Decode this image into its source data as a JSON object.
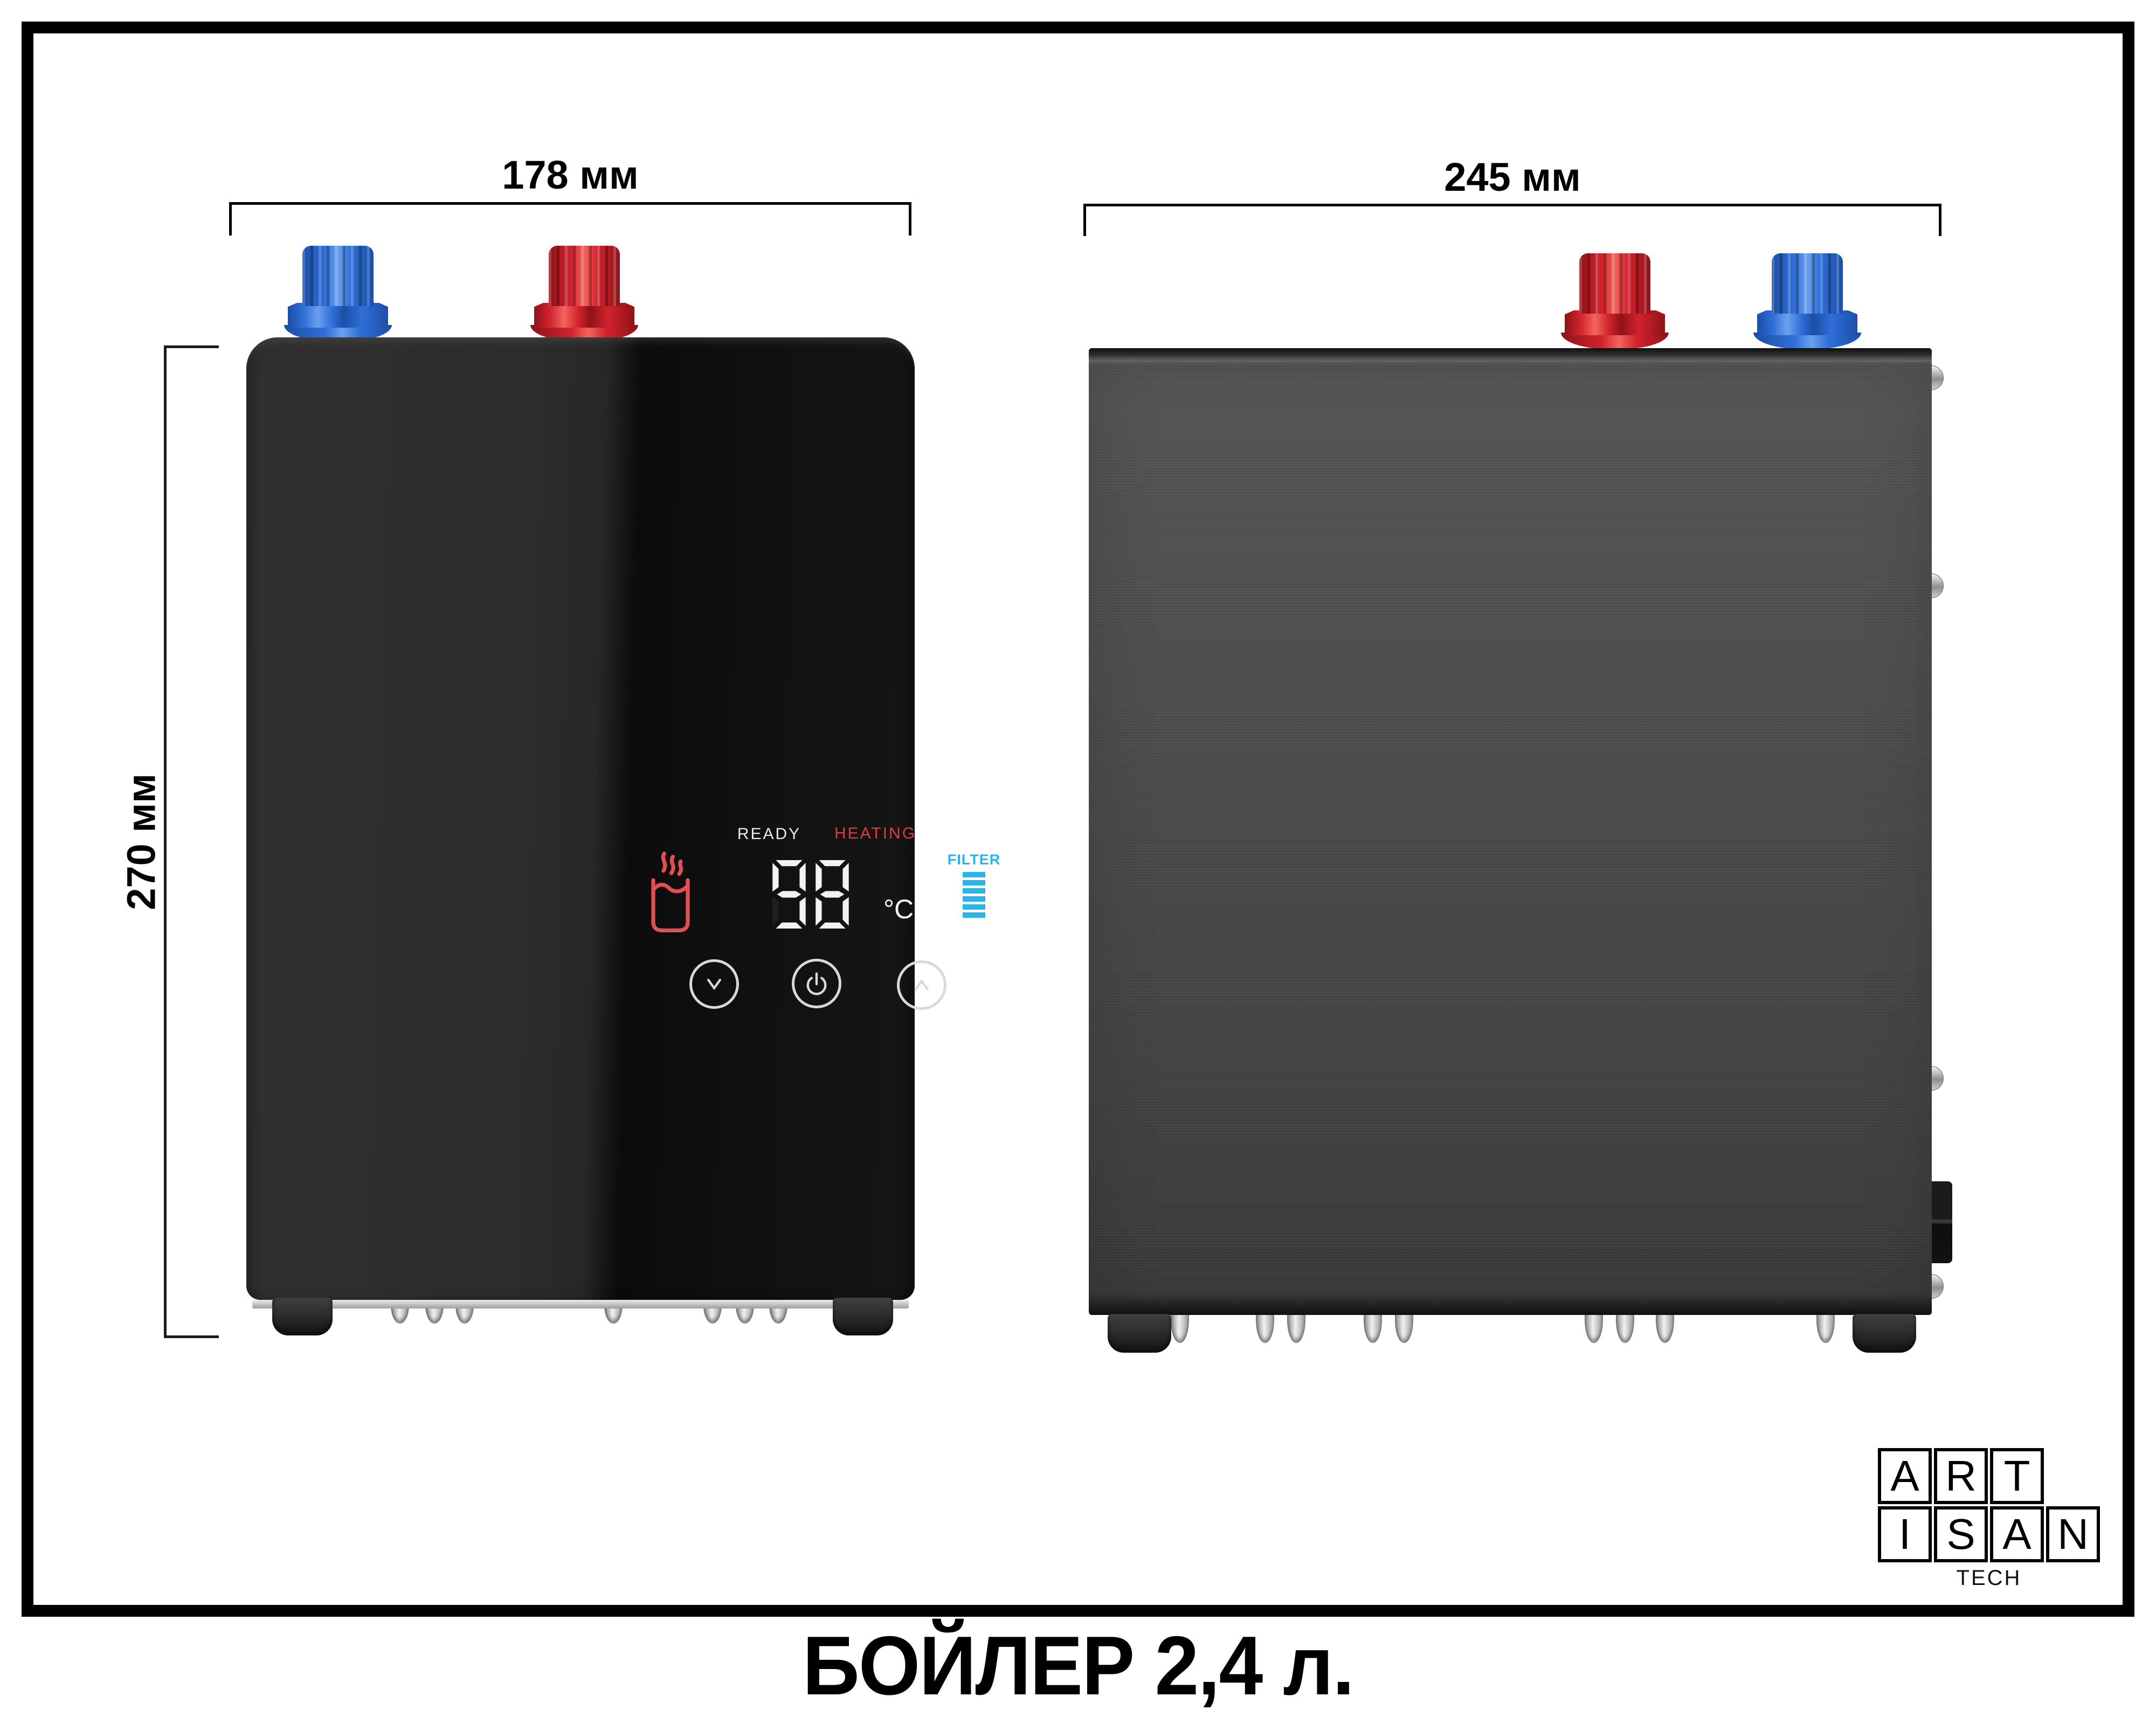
{
  "title": "БОЙЛЕР 2,4 л.",
  "dimensions": {
    "front_width": "178 мм",
    "front_height": "270 мм",
    "side_width": "245 мм"
  },
  "display": {
    "ready_label": "READY",
    "heating_label": "HEATING",
    "temperature": "98",
    "unit": "°C",
    "filter_label": "FILTER",
    "filter_bars": 6
  },
  "buttons": {
    "down": "chevron-down",
    "power": "power",
    "up": "chevron-up"
  },
  "logo": {
    "rows": [
      [
        "A",
        "R",
        "T"
      ],
      [
        "I",
        "S",
        "A",
        "N"
      ]
    ],
    "subtitle": "TECH"
  },
  "colors": {
    "hot": "#d2232e",
    "cold": "#2f6fd8",
    "heating_text": "#e23b3b",
    "ready_text": "#eaeaea",
    "filter_accent": "#2ab5ea",
    "cup_icon": "#e05050",
    "digit": "#f2f2f2"
  }
}
